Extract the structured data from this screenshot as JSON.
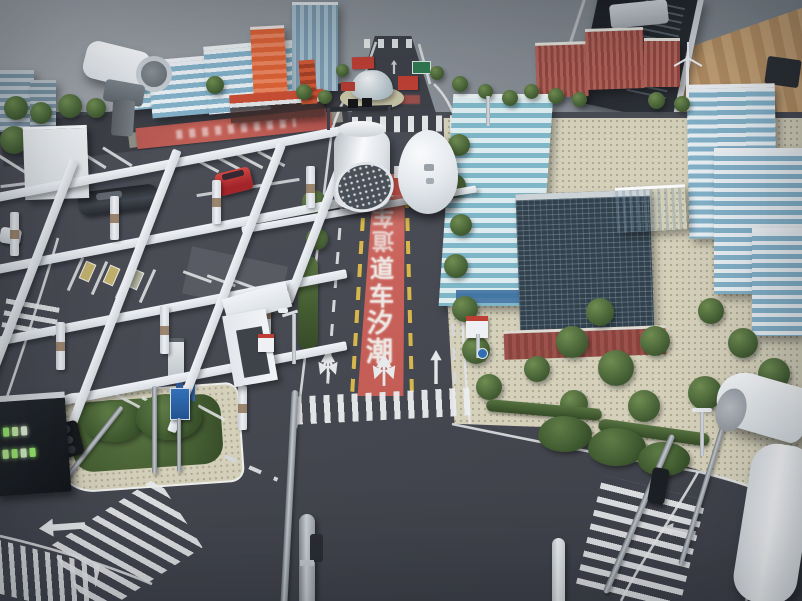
{
  "scene": {
    "description": "Indoor photograph of a miniature smart-city traffic scale model: a red tidal-flow lane with Chinese road text, crosswalks, a white elevated frame over a smart parking lot, office towers, surveillance cameras and street furniture.",
    "lane_name_meaning": "tidal flow lane"
  },
  "tidal_lane": {
    "label_chars": [
      "潮",
      "汐",
      "车",
      "道"
    ],
    "label_chars_far": [
      "道",
      "车",
      "汐"
    ],
    "lane_color": "#cd5f55"
  },
  "model_objects": {
    "cars": [
      "black-sedan",
      "red-suv",
      "white-car"
    ],
    "structures": [
      "white-frame-grid",
      "smart-parking-lot",
      "bus-canopy",
      "orange-transit-station",
      "glass-dome-pavilion",
      "blue-glass-towers",
      "dark-glass-tower",
      "brick-apartment-blocks",
      "striped-office-slabs"
    ],
    "devices": [
      "surveillance-camera-left",
      "surveillance-camera-right",
      "cylinder-pod",
      "egg-pod",
      "traffic-gantry",
      "traffic-signal",
      "led-traffic-display",
      "street-lamps",
      "wind-turbine"
    ]
  },
  "colors": {
    "asphalt": "#45464d",
    "red_lane": "#cd5f55",
    "lane_yellow": "#dcb945",
    "marking_white": "#eceded",
    "paving_tan": "#d8d3ba",
    "grass": "#4c6a33",
    "frame_white": "#eef0f2",
    "tower_blue": "#83b3ca",
    "tower_dark": "#2e3d47",
    "brick_red": "#a8524a",
    "station_orange": "#d95b33",
    "wall_gray": "#959a9f"
  }
}
